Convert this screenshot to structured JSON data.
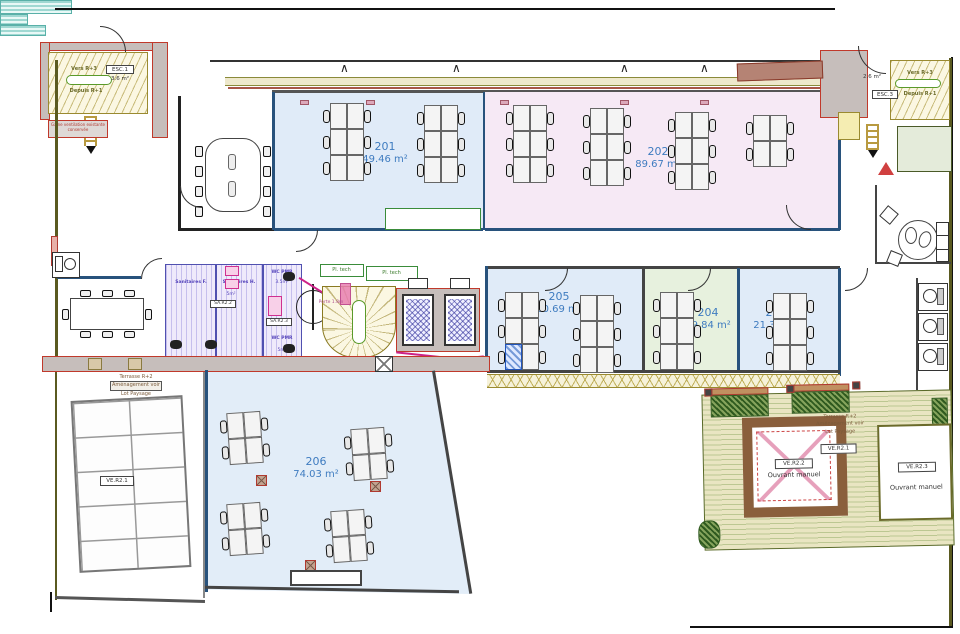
{
  "plan_type": "architectural-floor-plan",
  "rooms": [
    {
      "id": "201",
      "area": "49.46 m²",
      "fill": "#e0ebf8"
    },
    {
      "id": "202",
      "area": "89.67 m²",
      "fill": "#f6e9f5"
    },
    {
      "id": "205",
      "area": "30.69 m²",
      "fill": "#e0ebf8"
    },
    {
      "id": "204",
      "area": "19.84 m²",
      "fill": "#e7f1de"
    },
    {
      "id": "203",
      "area": "21.33 m²",
      "fill": "#e0ebf8"
    },
    {
      "id": "206",
      "area": "74.03 m²",
      "fill": "#e2edf8"
    }
  ],
  "stair_left": {
    "id": "ESC.1",
    "area": "3.6 m²",
    "up": "Vers R+3",
    "down": "Depuis R+1"
  },
  "stair_right": {
    "id": "ESC.3",
    "area": "2.6 m²",
    "up": "Vers R+3",
    "down": "Depuis R+1"
  },
  "core": {
    "pl_tech_1": "Pl. tech",
    "pl_tech_2": "Pl. tech",
    "san_f": "Sanitaires F.",
    "san_h": "Sanitaires H.",
    "san_h_area": "5m²",
    "sa_r22": "SA.R2.2",
    "sa_r23": "SA.R2.3",
    "wc_pmr_1": "WC PMR",
    "wc_pmr_1_area": "3.5m²",
    "wc_pmr_2": "WC PMR",
    "wc_pmr_2_area": "5m²",
    "porte": "Porte 1.8m"
  },
  "annotations": {
    "gaine": "Gaine ventilation existante conservée"
  },
  "terrace_left": {
    "line1": "Terrasse R+2",
    "line2": "Aménagement voir",
    "line3": "Lot Paysage",
    "skylight_tag": "VE.R2.1"
  },
  "terrace_right": {
    "line1": "Terrasse R+2",
    "line2": "Aménagement voir",
    "line3": "Lot Paysage",
    "mid_tag": "VE.R2.1",
    "brown_skylight_tag": "VE.R2.2",
    "brown_skylight_note": "Ouvrant manuel",
    "white_skylight_tag": "VE.R2.3",
    "white_skylight_note": "Ouvrant manuel"
  },
  "colors": {
    "room_label": "#3f7cc0",
    "wall_blue": "#28527c",
    "wall_red": "#c0392b",
    "stair_hatch": "#9a8a30",
    "terrace_wood": "#bcc792",
    "plants": "#2f5a1f",
    "sanitary": "#5050b0",
    "magenta": "#cc2288"
  }
}
